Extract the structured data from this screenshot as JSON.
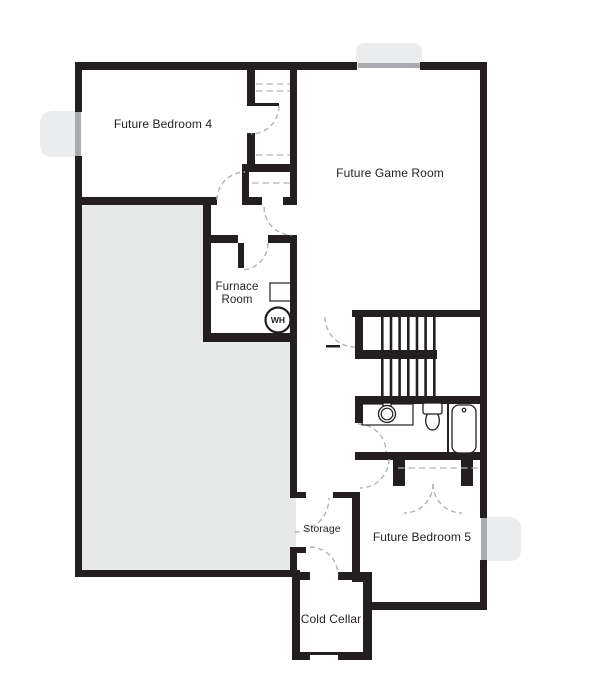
{
  "plan": {
    "rooms": {
      "bedroom4": {
        "label": "Future Bedroom 4"
      },
      "game_room": {
        "label": "Future Game Room"
      },
      "furnace_room": {
        "label": "Furnace Room"
      },
      "storage": {
        "label": "Storage"
      },
      "bedroom5": {
        "label": "Future Bedroom 5"
      },
      "cold_cellar": {
        "label": "Cold Cellar"
      }
    },
    "fixtures": {
      "water_heater": {
        "label": "WH"
      }
    },
    "colors": {
      "wall": "#231f20",
      "unfinished_fill": "#e7e8e8",
      "window_well": "#ebecee",
      "glass": "#a9abae",
      "door_arc": "#b0b3b6",
      "background": "#ffffff"
    }
  }
}
